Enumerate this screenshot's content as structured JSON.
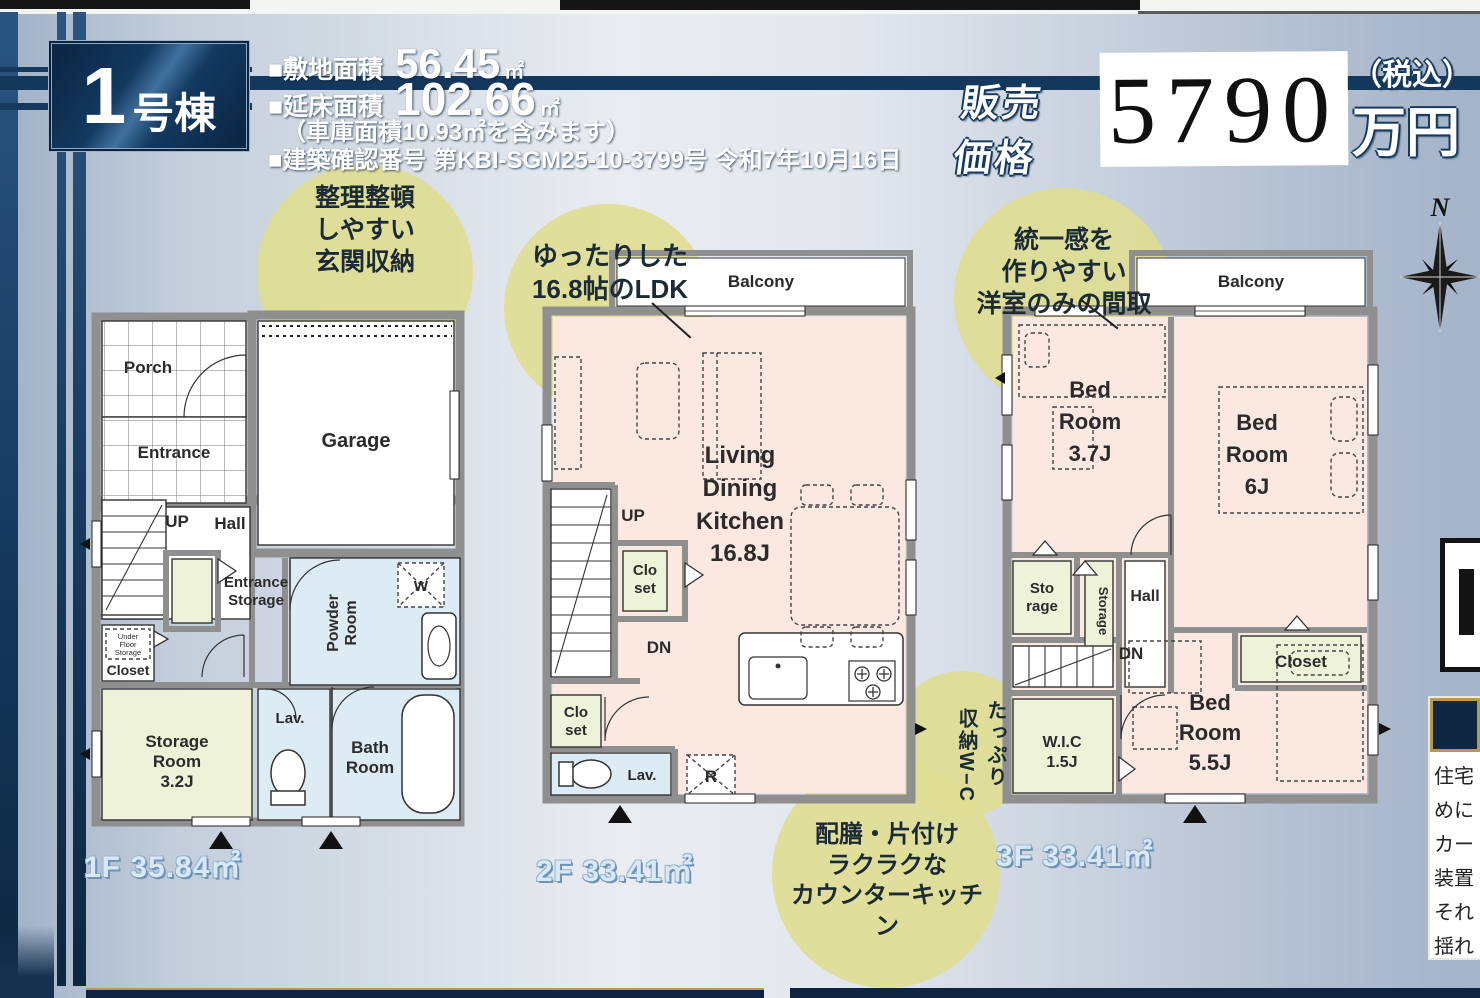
{
  "colors": {
    "navy": "#14375c",
    "bubble_yellow": "#dedd94",
    "room_pink": "#fbe9e1",
    "room_green": "#eef2d9",
    "room_blue": "#ddebf5",
    "price_sticker": "#ffffff"
  },
  "header": {
    "badge_number": "1",
    "badge_suffix": "号棟",
    "lot_label": "■敷地面積",
    "lot_value": "56.45",
    "lot_unit": "㎡",
    "tfa_label": "■延床面積",
    "tfa_value": "102.66",
    "tfa_unit": "㎡",
    "garage_note": "（車庫面積10.93㎡を含みます）",
    "permit": "■建築確認番号 第KBI-SGM25-10-3799号 令和7年10月16日",
    "price_label_line1": "販売",
    "price_label_line2": "価格",
    "price_value": "5790",
    "tax_note": "（税込）",
    "price_unit": "万円"
  },
  "compass": {
    "north": "N"
  },
  "f1": {
    "bubble": [
      "整理整頓",
      "しやすい",
      "玄関収納"
    ],
    "porch": "Porch",
    "entrance": "Entrance",
    "garage": "Garage",
    "up": "UP",
    "hall": "Hall",
    "ent_storage": [
      "Entrance",
      "Storage"
    ],
    "ufs": [
      "Under",
      "Floor",
      "Storage"
    ],
    "ufs_closet": "Closet",
    "storage": [
      "Storage",
      "Room",
      "3.2J"
    ],
    "lav": "Lav.",
    "powder": [
      "Powder",
      "Room"
    ],
    "bath": [
      "Bath",
      "Room"
    ],
    "w": "W",
    "area": "1F 35.84㎡"
  },
  "f2": {
    "bubble": [
      "ゆったりした",
      "16.8帖のLDK"
    ],
    "balcony": "Balcony",
    "ldk": [
      "Living",
      "Dining",
      "Kitchen",
      "16.8J"
    ],
    "up": "UP",
    "dn": "DN",
    "closet": [
      "Clo",
      "set"
    ],
    "lav": "Lav.",
    "r": "R",
    "area": "2F 33.41㎡",
    "bubble_kitchen": [
      "配膳・片付け",
      "ラクラクな",
      "カウンターキッチン"
    ]
  },
  "f3": {
    "bubble": [
      "統一感を",
      "作りやすい",
      "洋室のみの間取"
    ],
    "balcony": "Balcony",
    "bed37": [
      "Bed",
      "Room",
      "3.7J"
    ],
    "bed6": [
      "Bed",
      "Room",
      "6J"
    ],
    "bed55": [
      "Bed",
      "Room",
      "5.5J"
    ],
    "storage1": [
      "Sto",
      "rage"
    ],
    "storage2": "Storage",
    "hall": "Hall",
    "closet": "Closet",
    "dn": "DN",
    "wic": [
      "W.I.C",
      "1.5J"
    ],
    "bubble_wic": [
      "たっぷり",
      "収納W−C"
    ],
    "area": "3F 33.41㎡"
  },
  "right_panel": {
    "note_lines": [
      "住宅",
      "めに",
      "カー",
      "装置",
      "それ",
      "揺れ"
    ]
  }
}
